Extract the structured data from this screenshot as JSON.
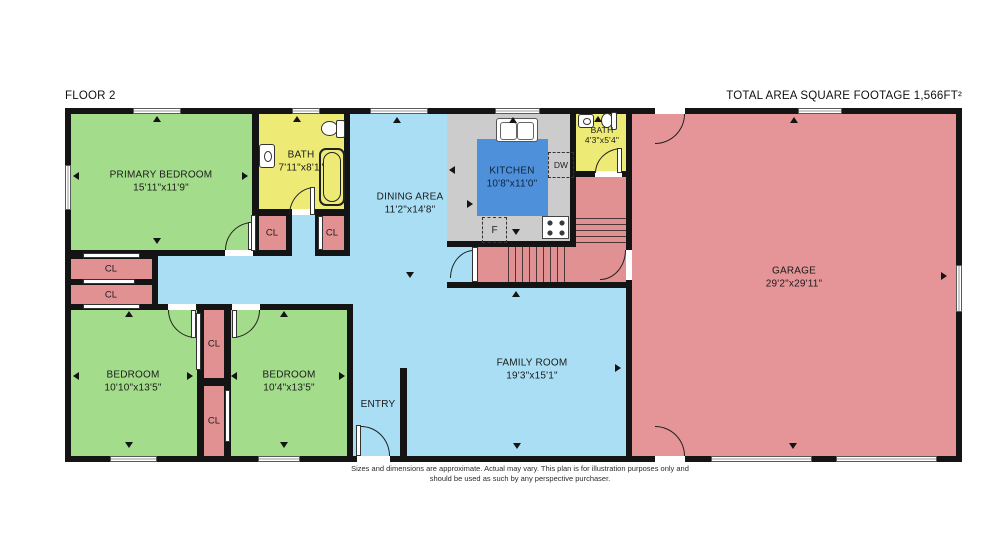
{
  "header": {
    "floor_label": "FLOOR 2",
    "total_area_label": "TOTAL AREA SQUARE FOOTAGE 1,566FT²"
  },
  "rooms": {
    "primary_bedroom": {
      "name": "PRIMARY BEDROOM",
      "dims": "15'11\"x11'9\""
    },
    "bath_main": {
      "name": "BATH",
      "dims": "7'11\"x8'1\""
    },
    "bath_small": {
      "name": "BATH",
      "dims": "4'3\"x5'4\""
    },
    "dining_area": {
      "name": "DINING AREA",
      "dims": "11'2\"x14'8\""
    },
    "kitchen": {
      "name": "KITCHEN",
      "dims": "10'8\"x11'0\""
    },
    "garage": {
      "name": "GARAGE",
      "dims": "29'2\"x29'11\""
    },
    "bedroom_left": {
      "name": "BEDROOM",
      "dims": "10'10\"x13'5\""
    },
    "bedroom_mid": {
      "name": "BEDROOM",
      "dims": "10'4\"x13'5\""
    },
    "family_room": {
      "name": "FAMILY ROOM",
      "dims": "19'3\"x15'1\""
    },
    "entry": {
      "name": "ENTRY"
    }
  },
  "closet_label": "CL",
  "appliances": {
    "dishwasher": "DW",
    "refrigerator": "F"
  },
  "disclaimer": {
    "line1": "Sizes and dimensions are approximate. Actual may vary. This plan is for illustration purposes only and",
    "line2": "should be used as such by any perspective purchaser."
  },
  "colors": {
    "bedroom_green": "#a3dc8b",
    "bath_yellow": "#edeb76",
    "living_blue": "#aadef4",
    "kitchen_highlight_blue": "#4e90d9",
    "garage_pink": "#e59597",
    "closet_pink": "#e29193",
    "counter_gray": "#cccccc",
    "wall_black": "#141414"
  }
}
